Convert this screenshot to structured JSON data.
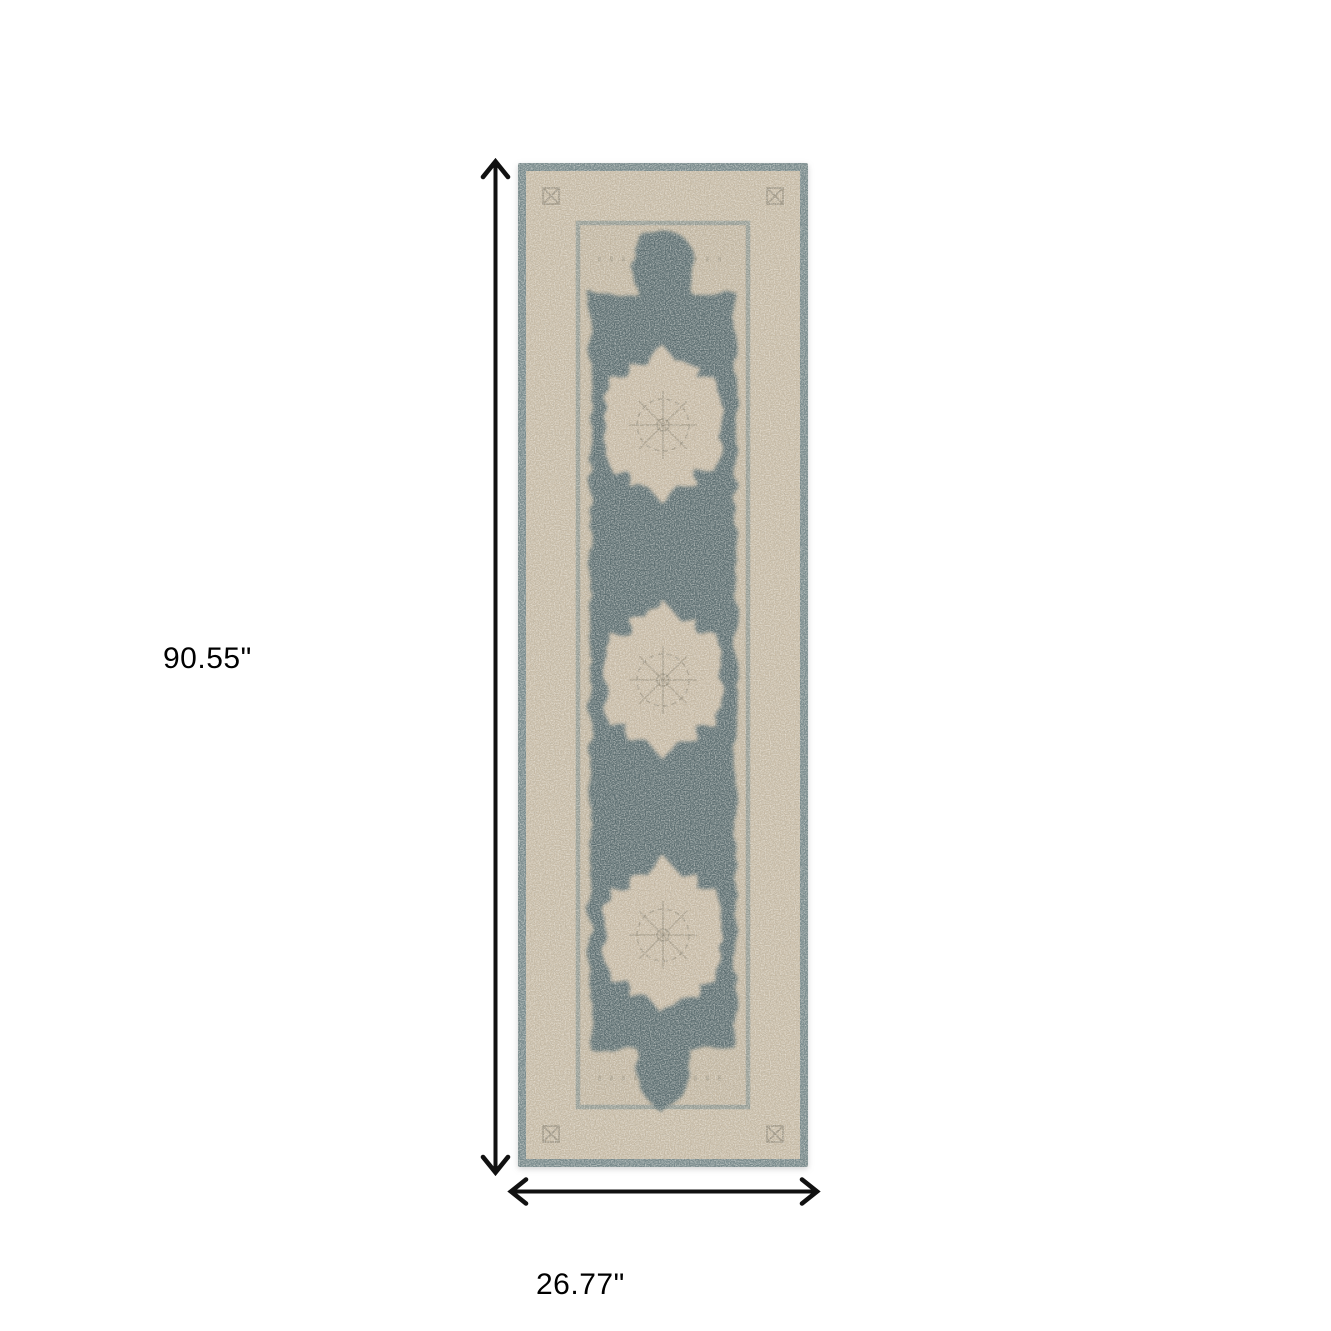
{
  "page": {
    "background_color": "#ffffff"
  },
  "figure": {
    "kind": "product-dimension-diagram",
    "subject": "distressed-medallion-runner-rug"
  },
  "rug": {
    "colors": {
      "binding": "#76888a",
      "border": "#c6baa5",
      "guard": "#7b8c8a",
      "field_ground": "#c2b6a1",
      "field_dark": "#54696d",
      "medallion": "#c7baa5",
      "ornament": "#8b8372"
    }
  },
  "annotations": {
    "arrow_color": "#111111",
    "height": {
      "label": "90.55\""
    },
    "width": {
      "label": "26.77\""
    }
  }
}
